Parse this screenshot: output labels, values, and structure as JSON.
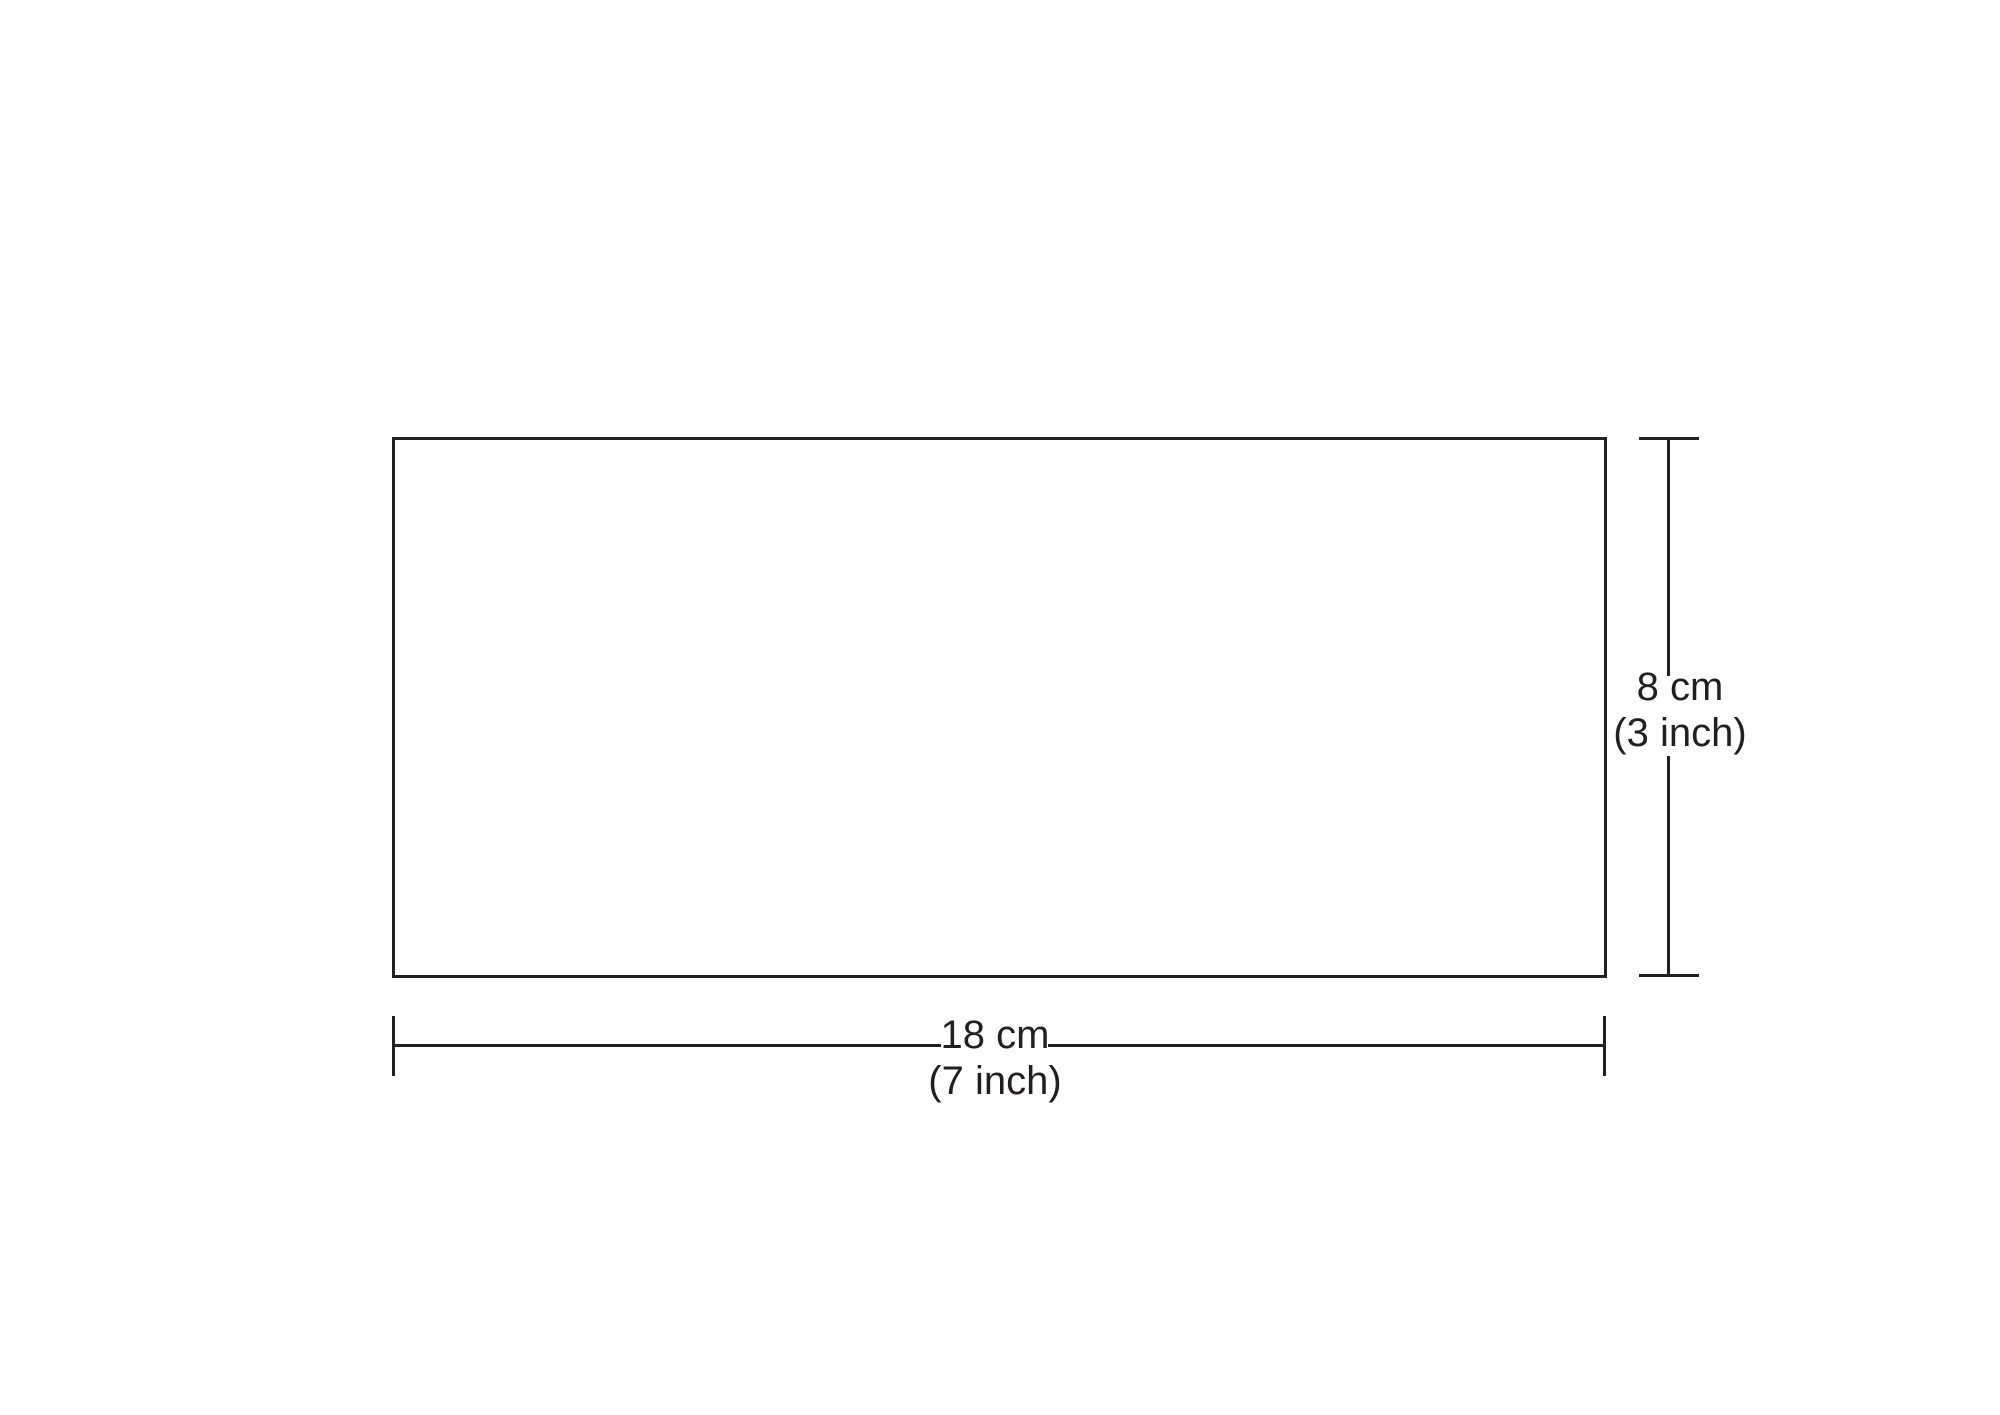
{
  "diagram": {
    "shape": "rectangle",
    "width": {
      "cm": 18,
      "inch": 7,
      "label_cm": "18 cm",
      "label_inch": "(7 inch)"
    },
    "height": {
      "cm": 8,
      "inch": 3,
      "label_cm": "8 cm",
      "label_inch": "(3 inch)"
    }
  },
  "colors": {
    "background": "#ffffff",
    "line": "#231f20",
    "text": "#231f20"
  }
}
